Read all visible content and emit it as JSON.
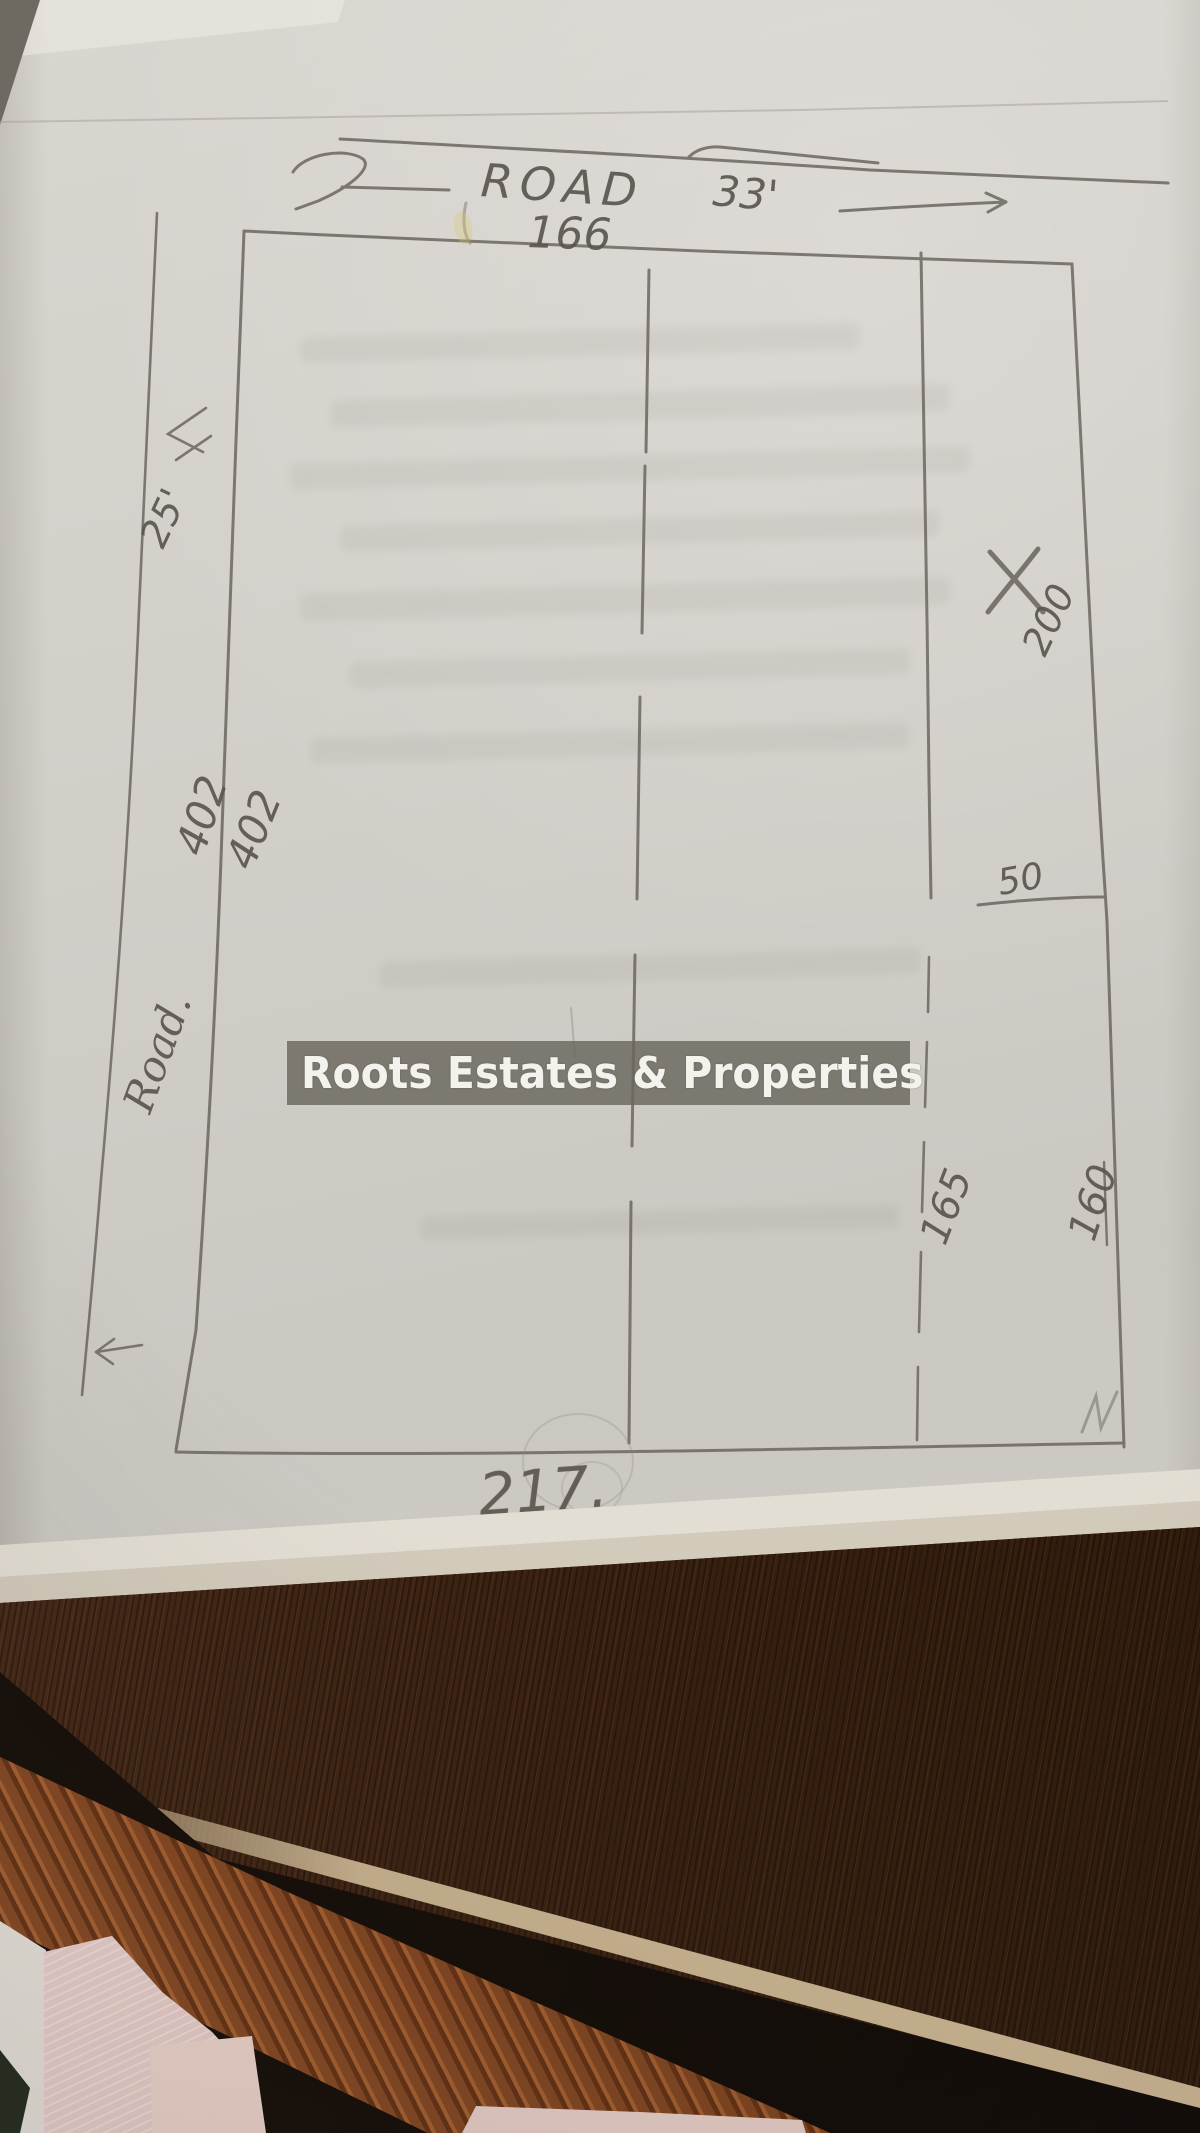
{
  "watermark": {
    "text": "Roots Estates & Properties"
  },
  "labels": {
    "road_top": "ROAD",
    "road_top_width": "33'",
    "top_length": "166",
    "left_road_width": "25'",
    "left_length_outer": "402",
    "left_length_inner": "402",
    "left_road_name": "Road.",
    "right_upper_length": "200",
    "notch_width": "50",
    "inner_lower_length": "165",
    "right_lower_length": "160",
    "bottom_length": "217."
  },
  "colors": {
    "pencil": "#6c675e",
    "paper": "#d2cfc9",
    "watermark_band": "#6a665e",
    "watermark_text": "#f4f2ed",
    "table_dark_wood": "#3f2517",
    "table_plank": "#8a4a22",
    "fabric_pink": "#e4c8c4"
  }
}
